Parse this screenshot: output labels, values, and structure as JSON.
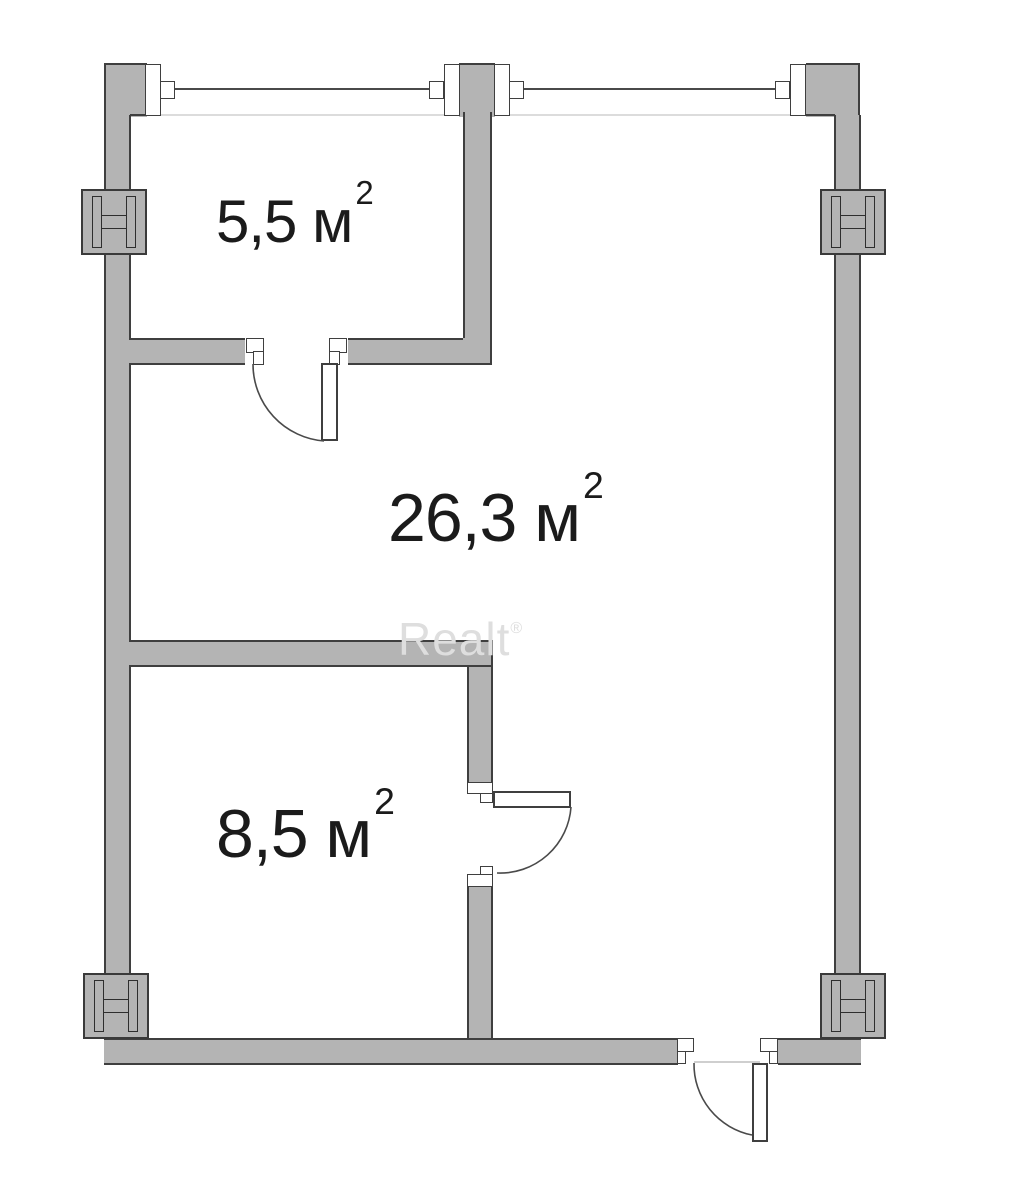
{
  "plan": {
    "rooms": [
      {
        "id": "room-top-small",
        "area_label": "5,5 м",
        "sup": "2"
      },
      {
        "id": "room-main",
        "area_label": "26,3 м",
        "sup": "2"
      },
      {
        "id": "room-bottom-small",
        "area_label": "8,5 м",
        "sup": "2"
      }
    ],
    "watermark": "Realt",
    "watermark_mark": "®",
    "symbols": {
      "column": "steel-i-beam-column"
    },
    "colors": {
      "wall_fill": "#b4b4b4",
      "wall_outline": "#3f3f3f",
      "window_line": "#4a4a4a",
      "label_text": "#1b1b1b",
      "watermark_text": "#dedede",
      "background": "#ffffff"
    }
  }
}
